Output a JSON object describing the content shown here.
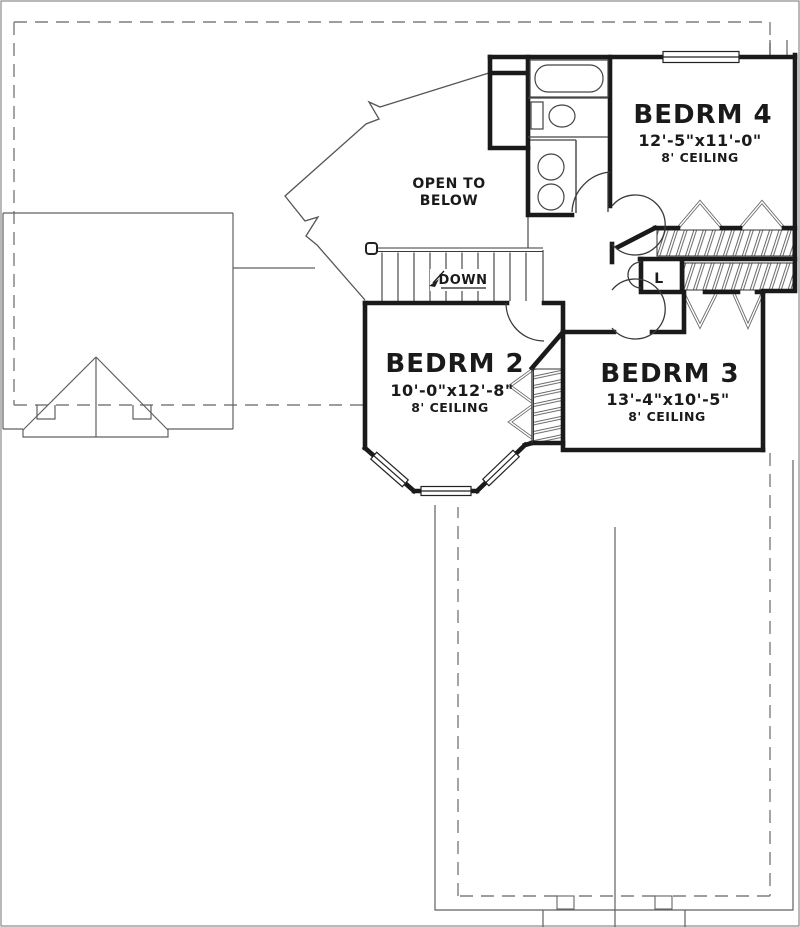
{
  "plan": {
    "rooms": {
      "bedrm4": {
        "name": "BEDRM 4",
        "dims": "12'-5\"x11'-0\"",
        "ceiling": "8' CEILING"
      },
      "bedrm2": {
        "name": "BEDRM 2",
        "dims": "10'-0\"x12'-8\"",
        "ceiling": "8' CEILING"
      },
      "bedrm3": {
        "name": "BEDRM 3",
        "dims": "13'-4\"x10'-5\"",
        "ceiling": "8' CEILING"
      }
    },
    "labels": {
      "open_to_below_1": "OPEN TO",
      "open_to_below_2": "BELOW",
      "down": "DOWN",
      "linen_closet": "L"
    },
    "colors": {
      "wall": "#1a1a1a",
      "thin_line": "#555555",
      "dashed_line": "#7d7d7d",
      "background": "#ffffff"
    }
  }
}
